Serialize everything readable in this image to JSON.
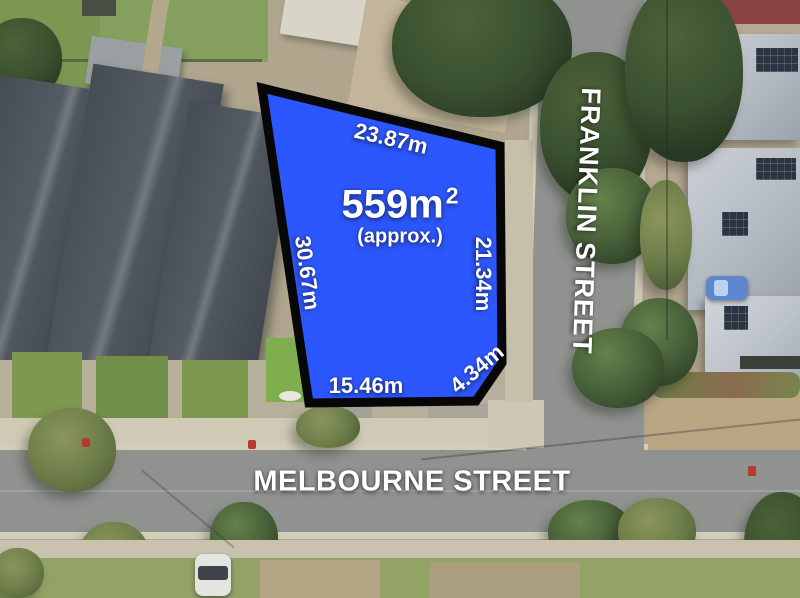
{
  "parcel": {
    "area": "559m",
    "area_superscript": "2",
    "area_qualifier": "(approx.)",
    "fill_color": "#2d57fe",
    "outline_color": "#070707",
    "dimensions": [
      {
        "side": "top",
        "label": "23.87m"
      },
      {
        "side": "left",
        "label": "30.67m"
      },
      {
        "side": "right",
        "label": "21.34m"
      },
      {
        "side": "bottom",
        "label": "15.46m"
      },
      {
        "side": "bottom-right",
        "label": "4.34m"
      }
    ]
  },
  "streets": [
    {
      "name": "FRANKLIN STREET",
      "orientation": "vertical"
    },
    {
      "name": "MELBOURNE STREET",
      "orientation": "horizontal"
    }
  ],
  "label_color": "#ffffff"
}
